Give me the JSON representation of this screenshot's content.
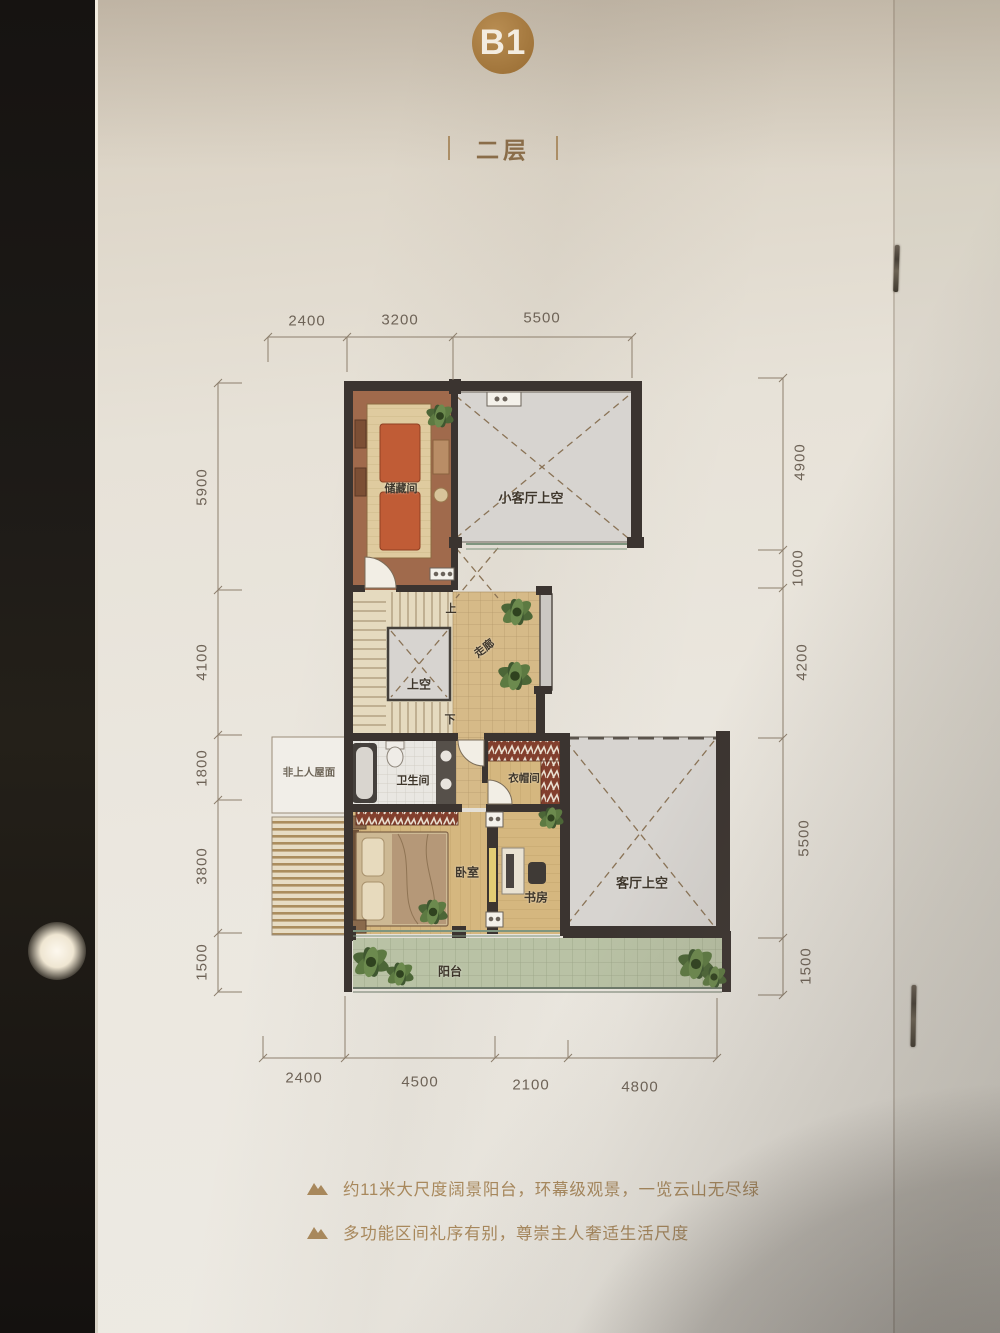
{
  "header": {
    "unit": "B1",
    "floor": "二层"
  },
  "dimensions": {
    "top": [
      "2400",
      "3200",
      "5500"
    ],
    "left": [
      "5900",
      "4100",
      "1800",
      "3800",
      "1500"
    ],
    "right": [
      "4900",
      "1000",
      "4200",
      "5500",
      "1500"
    ],
    "bottom": [
      "2400",
      "4500",
      "2100",
      "4800"
    ]
  },
  "plan": {
    "rooms": {
      "storage": "储藏间",
      "small_living_void": "小客厅上空",
      "void_above": "上空",
      "corridor": "走廊",
      "non_access_roof": "非上人屋面",
      "bathroom": "卫生间",
      "cloakroom": "衣帽间",
      "bedroom": "卧室",
      "study": "书房",
      "living_void": "客厅上空",
      "balcony": "阳台"
    },
    "stairs": {
      "up": "上",
      "down": "下"
    }
  },
  "features": [
    "约11米大尺度阔景阳台，环幕级观景，一览云山无尽绿",
    "多功能区间礼序有别，尊崇主人奢适生活尺度"
  ],
  "colors": {
    "badge": "#a87c42",
    "accent_text": "#a8885c",
    "wall": "#3b3430",
    "floor_tan": "#d6ba88",
    "floor_wood": "#d5b77f",
    "void_gray": "#d7d4d0",
    "balcony_green": "#b9c2a5",
    "storage_brown": "#a06a4c",
    "wardrobe_red": "#823f2d"
  }
}
